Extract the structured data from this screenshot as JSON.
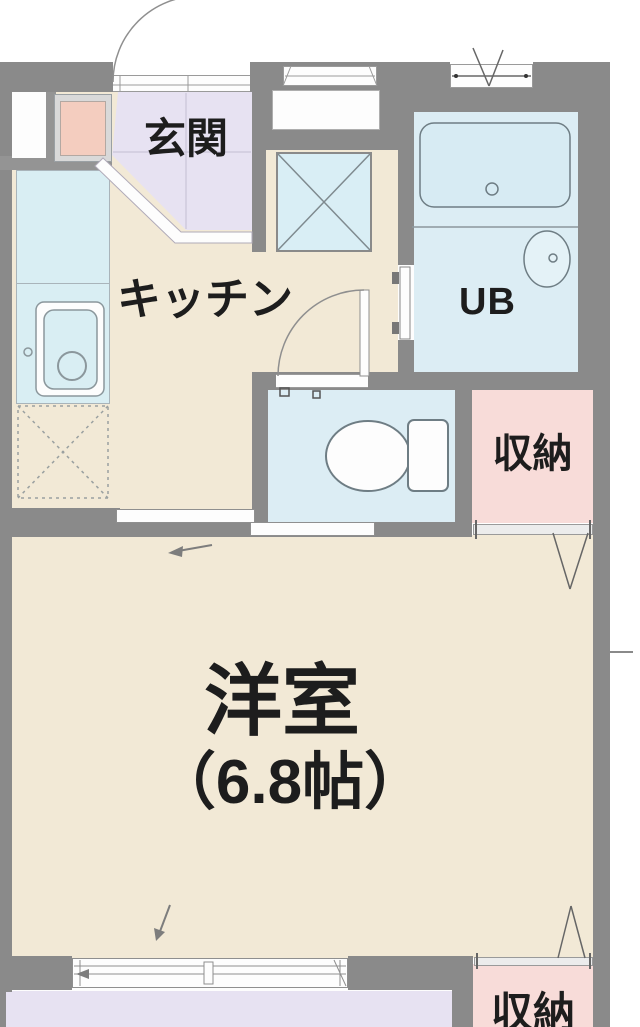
{
  "rooms": {
    "genkan": {
      "label": "玄関"
    },
    "kitchen": {
      "label": "キッチン"
    },
    "unit_bath": {
      "label": "UB"
    },
    "western_room": {
      "label": "洋室",
      "size": "（6.8帖）"
    },
    "storage_upper": {
      "label": "収納"
    },
    "storage_lower": {
      "label": "収納"
    }
  },
  "fixtures": [
    "entrance-door-swing",
    "shoe-cabinet",
    "meter-box",
    "kitchen-counter",
    "kitchen-sink",
    "refrigerator-space",
    "washing-machine-space",
    "pipe-space",
    "window",
    "bathtub",
    "washbasin",
    "toilet",
    "toilet-door-swing",
    "unit-bath-door",
    "sliding-partition-door",
    "storage-folding-door",
    "balcony-sliding-window",
    "balcony"
  ],
  "colors": {
    "wall": "#8a8a8a",
    "floor": "#f2e9d6",
    "entrance": "#e7e2f2",
    "wet_area": "#dcedf4",
    "bathtub": "#d7ebf3",
    "storage": "#f8dcd9",
    "shoe_cabinet": "#f4cdbf",
    "balcony": "#e7e2f2",
    "fixture_outline": "#6e7d84",
    "text": "#1d1d1d"
  }
}
